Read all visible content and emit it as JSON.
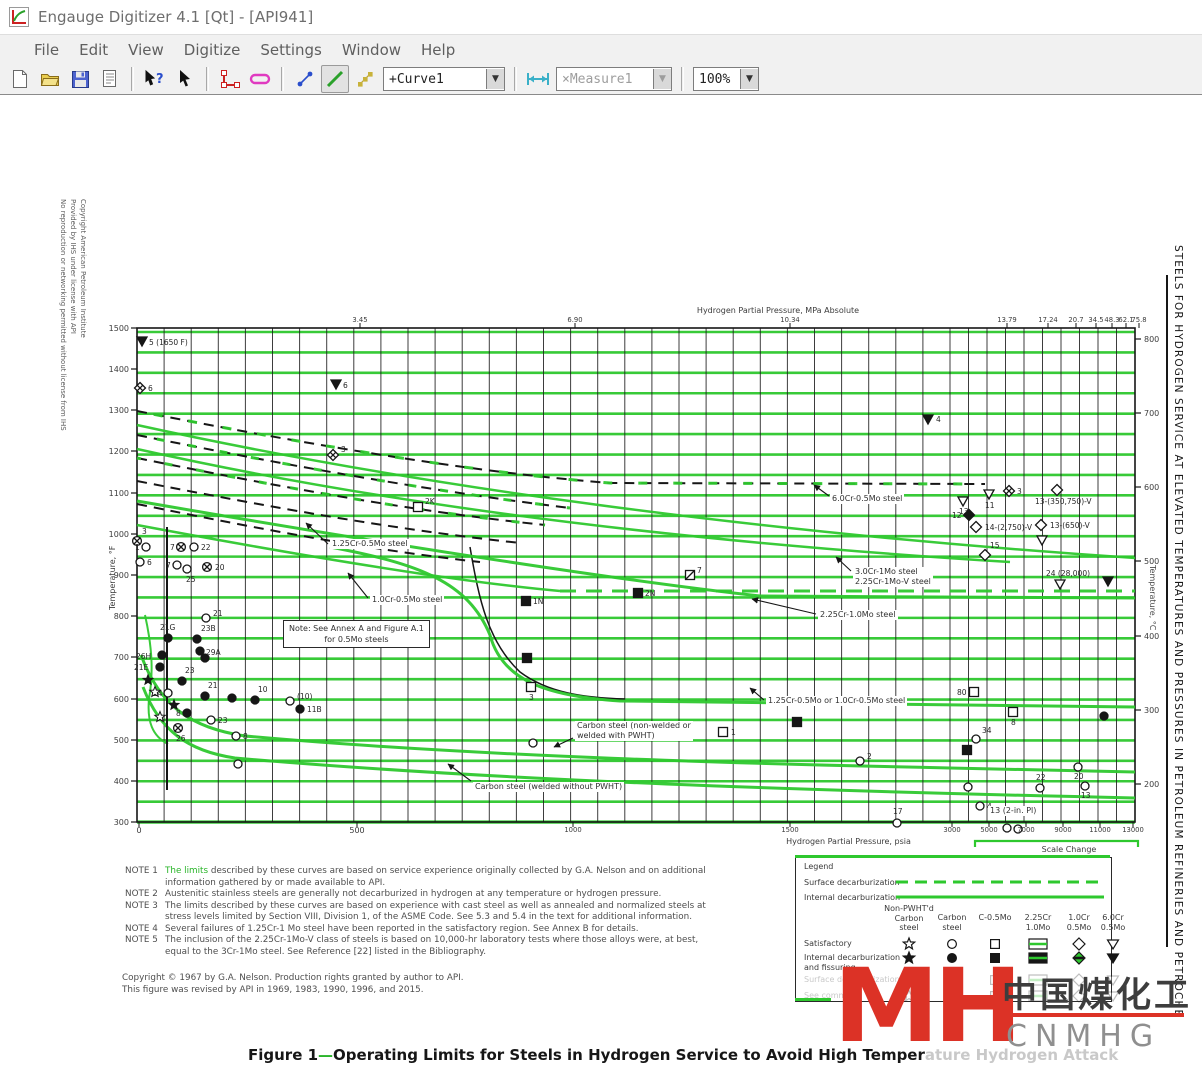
{
  "window": {
    "title": "Engauge Digitizer 4.1 [Qt] - [API941]",
    "menus": [
      "File",
      "Edit",
      "View",
      "Digitize",
      "Settings",
      "Window",
      "Help"
    ]
  },
  "toolbar": {
    "curve_select": "+Curve1",
    "measure_select": "×Measure1",
    "zoom_select": "100%"
  },
  "side_texts": {
    "left_copyright": [
      "Copyright American Petroleum Institute",
      "Provided by IHS under license with API",
      "No reproduction or networking permitted without license from IHS"
    ],
    "right_title": "STEELS FOR HYDROGEN SERVICE AT ELEVATED TEMPERATURES AND PRESSURES IN PETROLEUM REFINERIES AND PETROCHE"
  },
  "chart": {
    "plot": {
      "x0": 137,
      "y0": 233,
      "x1": 1135,
      "y1": 727
    },
    "grid": {
      "vx_main": {
        "start": 137,
        "end": 950,
        "step": 27.1
      },
      "vx_right": {
        "start": 950,
        "end": 1135,
        "step": 18.5
      },
      "hy": {
        "start": 237,
        "end": 727,
        "step": 20.42
      }
    },
    "top_axis": {
      "title": "Hydrogen Partial Pressure, MPa Absolute",
      "ticks": [
        {
          "t": "3.45",
          "x": 360
        },
        {
          "t": "6.90",
          "x": 575
        },
        {
          "t": "10.34",
          "x": 790
        },
        {
          "t": "13.79",
          "x": 1007
        },
        {
          "t": "17.24",
          "x": 1048
        },
        {
          "t": "20.7",
          "x": 1076
        },
        {
          "t": "34.5",
          "x": 1096
        },
        {
          "t": "48.3",
          "x": 1112
        },
        {
          "t": "62.1",
          "x": 1126
        },
        {
          "t": "75.8",
          "x": 1139
        }
      ]
    },
    "bottom_axis": {
      "title": "Hydrogen Partial Pressure, psia",
      "ticks": [
        {
          "t": "0",
          "x": 139
        },
        {
          "t": "500",
          "x": 357
        },
        {
          "t": "1000",
          "x": 573
        },
        {
          "t": "1500",
          "x": 790
        },
        {
          "t": "3000",
          "x": 952
        },
        {
          "t": "5000",
          "x": 989
        },
        {
          "t": "7000",
          "x": 1026
        },
        {
          "t": "9000",
          "x": 1063
        },
        {
          "t": "11000",
          "x": 1100
        },
        {
          "t": "13000",
          "x": 1133
        }
      ]
    },
    "left_axis": {
      "title": "Temperature, °F",
      "ticks": [
        {
          "t": "1500",
          "y": 233
        },
        {
          "t": "1400",
          "y": 274
        },
        {
          "t": "1300",
          "y": 315
        },
        {
          "t": "1200",
          "y": 356
        },
        {
          "t": "1100",
          "y": 398
        },
        {
          "t": "1000",
          "y": 439
        },
        {
          "t": "900",
          "y": 480
        },
        {
          "t": "800",
          "y": 521
        },
        {
          "t": "700",
          "y": 562
        },
        {
          "t": "600",
          "y": 604
        },
        {
          "t": "500",
          "y": 645
        },
        {
          "t": "400",
          "y": 686
        },
        {
          "t": "300",
          "y": 727
        }
      ]
    },
    "right_axis": {
      "title": "Temperature, °C",
      "ticks": [
        {
          "t": "800",
          "y": 244
        },
        {
          "t": "700",
          "y": 318
        },
        {
          "t": "600",
          "y": 392
        },
        {
          "t": "500",
          "y": 466
        },
        {
          "t": "400",
          "y": 541
        },
        {
          "t": "300",
          "y": 615
        },
        {
          "t": "200",
          "y": 689
        }
      ]
    },
    "scale_change": {
      "label": "Scale Change",
      "x1": 975,
      "x2": 1138,
      "y": 746
    },
    "note_box": {
      "lines": [
        "Note:  See Annex A and Figure A.1",
        "for 0.5Mo steels"
      ],
      "x": 283,
      "y": 525
    },
    "labels": [
      {
        "lines": [
          "1.25Cr-0.5Mo steel"
        ],
        "x": 330,
        "y": 444,
        "arrow": [
          328,
          449,
          306,
          428
        ]
      },
      {
        "lines": [
          "1.0Cr-0.5Mo steel"
        ],
        "x": 370,
        "y": 500,
        "arrow": [
          368,
          503,
          348,
          478
        ]
      },
      {
        "lines": [
          "6.0Cr-0.5Mo steel"
        ],
        "x": 830,
        "y": 399,
        "arrow": [
          829,
          401,
          814,
          390
        ]
      },
      {
        "lines": [
          "3.0Cr-1Mo steel",
          "2.25Cr-1Mo-V steel"
        ],
        "x": 853,
        "y": 472,
        "arrow": [
          851,
          476,
          836,
          462
        ]
      },
      {
        "lines": [
          "2.25Cr-1.0Mo steel"
        ],
        "x": 818,
        "y": 515,
        "arrow": [
          816,
          519,
          752,
          504
        ]
      },
      {
        "lines": [
          "1.25Cr-0.5Mo or 1.0Cr-0.5Mo steel"
        ],
        "x": 766,
        "y": 601,
        "arrow": [
          764,
          605,
          750,
          593
        ]
      },
      {
        "lines": [
          "Carbon steel (non-welded or",
          "welded with PWHT)"
        ],
        "x": 575,
        "y": 626,
        "arrow": [
          573,
          643,
          554,
          652
        ]
      },
      {
        "lines": [
          "Carbon steel (welded without PWHT)"
        ],
        "x": 473,
        "y": 687,
        "arrow": [
          471,
          686,
          448,
          669
        ]
      },
      {
        "lines": [
          "13 (2-in. Pl)"
        ],
        "x": 988,
        "y": 711,
        "arrow": null
      }
    ],
    "green_curves": [
      {
        "d": "M137,330 C420,392 760,438 1135,463",
        "w": 2.5
      },
      {
        "d": "M137,354 C400,413 700,448 1010,467",
        "w": 2.5
      },
      {
        "d": "M137,406 C420,455 640,488 760,501 L1135,503",
        "w": 3
      },
      {
        "d": "M137,430 C340,468 480,489 560,496",
        "w": 2.5
      },
      {
        "d": "M560,496 L1135,496",
        "w": 3,
        "dash": "16,10"
      },
      {
        "d": "M330,452 C420,469 468,487 490,540 C502,585 545,601 620,606 L1135,612",
        "w": 3
      },
      {
        "d": "M141,560 C160,612 192,633 245,641 C480,662 760,669 950,673 L1135,677",
        "w": 3
      },
      {
        "d": "M143,592 C160,636 188,656 235,663 C500,686 820,696 1135,703",
        "w": 3
      },
      {
        "d": "M145,520 C153,556 153,580 149,604 C147,626 152,641 168,649",
        "w": 2
      },
      {
        "d": "M137,316 C320,352 480,378 610,388 L985,389",
        "w": 3,
        "dash": "9,26",
        "off": 18
      },
      {
        "d": "M137,340 C290,371 430,396 570,413",
        "w": 3,
        "dash": "8,24",
        "off": 12
      },
      {
        "d": "M137,363 C280,392 410,416 545,430",
        "w": 3,
        "dash": "8,24",
        "off": 4
      }
    ],
    "black_curves": [
      {
        "d": "M137,316 C320,352 480,378 610,388 L985,389",
        "w": 2,
        "dash": "10,7"
      },
      {
        "d": "M137,340 C290,371 430,396 570,413",
        "w": 2,
        "dash": "10,7"
      },
      {
        "d": "M137,363 C280,392 410,416 545,430",
        "w": 2,
        "dash": "10,7"
      },
      {
        "d": "M137,386 C270,412 390,434 520,448",
        "w": 2,
        "dash": "10,7"
      },
      {
        "d": "M137,409 C260,434 370,455 480,467",
        "w": 2,
        "dash": "10,7"
      },
      {
        "d": "M470,452 C479,505 488,547 520,577 C548,598 585,603 625,604",
        "w": 1.5
      }
    ],
    "extra_lines": [
      {
        "x1": 167,
        "y1": 432,
        "x2": 167,
        "y2": 695,
        "w": 2
      }
    ],
    "points": [
      {
        "s": "tf",
        "x": 142,
        "y": 246,
        "t": "5 (1650 F)",
        "dx": 7,
        "dy": 4
      },
      {
        "s": "dx",
        "x": 140,
        "y": 293,
        "t": "6",
        "dx": 8,
        "dy": 3
      },
      {
        "s": "tf",
        "x": 336,
        "y": 289,
        "t": "6",
        "dx": 7,
        "dy": 4
      },
      {
        "s": "dx",
        "x": 333,
        "y": 360,
        "t": "3",
        "dx": 8,
        "dy": -3
      },
      {
        "s": "tf",
        "x": 928,
        "y": 324,
        "t": "4",
        "dx": 8,
        "dy": 3
      },
      {
        "s": "so",
        "x": 418,
        "y": 412,
        "t": "2K",
        "dx": 7,
        "dy": -3
      },
      {
        "s": "to",
        "x": 963,
        "y": 406,
        "t": "13",
        "dx": -4,
        "dy": 13
      },
      {
        "s": "to",
        "x": 989,
        "y": 399,
        "t": "11",
        "dx": -4,
        "dy": 14
      },
      {
        "s": "dx",
        "x": 1009,
        "y": 396,
        "t": "3",
        "dx": 8,
        "dy": 3
      },
      {
        "s": "do",
        "x": 1057,
        "y": 395,
        "t": "13-(350,750)-V",
        "dx": -22,
        "dy": 14
      },
      {
        "s": "df",
        "x": 969,
        "y": 420,
        "t": "12",
        "dx": -17,
        "dy": 3
      },
      {
        "s": "do",
        "x": 976,
        "y": 432,
        "t": "14-(2,750)-V",
        "dx": 9,
        "dy": 3
      },
      {
        "s": "do",
        "x": 1041,
        "y": 430,
        "t": "13-(650)-V",
        "dx": 9,
        "dy": 3
      },
      {
        "s": "to",
        "x": 1042,
        "y": 445,
        "t": ""
      },
      {
        "s": "do",
        "x": 985,
        "y": 460,
        "t": "15",
        "dx": 5,
        "dy": -7
      },
      {
        "s": "to",
        "x": 1060,
        "y": 489,
        "t": "24 (28,000)",
        "dx": -14,
        "dy": -8
      },
      {
        "s": "tf",
        "x": 1108,
        "y": 486,
        "t": ""
      },
      {
        "s": "sf",
        "x": 638,
        "y": 498,
        "t": "2N",
        "dx": 7,
        "dy": 3
      },
      {
        "s": "sf",
        "x": 526,
        "y": 506,
        "t": "1N",
        "dx": 7,
        "dy": 3
      },
      {
        "s": "sx",
        "x": 690,
        "y": 480,
        "t": "7",
        "dx": 7,
        "dy": -2
      },
      {
        "s": "sf",
        "x": 527,
        "y": 563,
        "t": ""
      },
      {
        "s": "so",
        "x": 531,
        "y": 592,
        "t": "3",
        "dx": -2,
        "dy": 13
      },
      {
        "s": "so",
        "x": 723,
        "y": 637,
        "t": "1",
        "dx": 8,
        "dy": 3
      },
      {
        "s": "co",
        "x": 860,
        "y": 666,
        "t": "2",
        "dx": 7,
        "dy": -2
      },
      {
        "s": "co",
        "x": 897,
        "y": 728,
        "t": "17",
        "dx": -4,
        "dy": -9
      },
      {
        "s": "so",
        "x": 974,
        "y": 597,
        "t": "80",
        "dx": -17,
        "dy": 3
      },
      {
        "s": "so",
        "x": 1013,
        "y": 617,
        "t": "8",
        "dx": -2,
        "dy": 13
      },
      {
        "s": "cf",
        "x": 1104,
        "y": 621,
        "t": ""
      },
      {
        "s": "sf",
        "x": 967,
        "y": 655,
        "t": ""
      },
      {
        "s": "co",
        "x": 976,
        "y": 644,
        "t": "34",
        "dx": 6,
        "dy": -6
      },
      {
        "s": "co",
        "x": 1078,
        "y": 672,
        "t": "20",
        "dx": -4,
        "dy": 12
      },
      {
        "s": "co",
        "x": 1085,
        "y": 691,
        "t": "13",
        "dx": -4,
        "dy": 12
      },
      {
        "s": "co",
        "x": 968,
        "y": 692,
        "t": ""
      },
      {
        "s": "co",
        "x": 980,
        "y": 711,
        "t": "4",
        "dx": 7,
        "dy": 3
      },
      {
        "s": "co",
        "x": 1007,
        "y": 733,
        "t": ""
      },
      {
        "s": "co",
        "x": 1018,
        "y": 734,
        "t": ""
      },
      {
        "s": "co",
        "x": 1040,
        "y": 693,
        "t": "22",
        "dx": -4,
        "dy": -8
      },
      {
        "s": "sf",
        "x": 797,
        "y": 627,
        "t": ""
      },
      {
        "s": "co",
        "x": 533,
        "y": 648,
        "t": ""
      },
      {
        "s": "cx",
        "x": 137,
        "y": 446,
        "t": "3",
        "dx": 5,
        "dy": -7
      },
      {
        "s": "co",
        "x": 146,
        "y": 452,
        "t": "1",
        "dx": -11,
        "dy": 3
      },
      {
        "s": "co",
        "x": 140,
        "y": 467,
        "t": "6",
        "dx": 7,
        "dy": 3
      },
      {
        "s": "cx",
        "x": 181,
        "y": 452,
        "t": "7",
        "dx": -11,
        "dy": 3
      },
      {
        "s": "co",
        "x": 194,
        "y": 452,
        "t": "22",
        "dx": 7,
        "dy": 3
      },
      {
        "s": "co",
        "x": 177,
        "y": 470,
        "t": "7",
        "dx": -11,
        "dy": 3
      },
      {
        "s": "co",
        "x": 187,
        "y": 474,
        "t": "25",
        "dx": -1,
        "dy": 13
      },
      {
        "s": "cx",
        "x": 207,
        "y": 472,
        "t": "20",
        "dx": 8,
        "dy": 3
      },
      {
        "s": "co",
        "x": 206,
        "y": 523,
        "t": "21",
        "dx": 7,
        "dy": -2
      },
      {
        "s": "cf",
        "x": 168,
        "y": 543,
        "t": "21G",
        "dx": -8,
        "dy": -8
      },
      {
        "s": "cf",
        "x": 197,
        "y": 544,
        "t": "23B",
        "dx": 4,
        "dy": -8
      },
      {
        "s": "cf",
        "x": 162,
        "y": 560,
        "t": "26H",
        "dx": -26,
        "dy": 4
      },
      {
        "s": "cf",
        "x": 200,
        "y": 556,
        "t": "29A",
        "dx": 6,
        "dy": 4
      },
      {
        "s": "cf",
        "x": 160,
        "y": 572,
        "t": "21E",
        "dx": -26,
        "dy": 3
      },
      {
        "s": "cf",
        "x": 205,
        "y": 563,
        "t": ""
      },
      {
        "s": "st",
        "x": 148,
        "y": 585,
        "t": ""
      },
      {
        "s": "cf",
        "x": 182,
        "y": 586,
        "t": "23",
        "dx": 3,
        "dy": -8
      },
      {
        "s": "co",
        "x": 168,
        "y": 598,
        "t": "24",
        "dx": -15,
        "dy": 3
      },
      {
        "s": "cf",
        "x": 205,
        "y": 601,
        "t": "21",
        "dx": 3,
        "dy": -8
      },
      {
        "s": "cf",
        "x": 232,
        "y": 603,
        "t": ""
      },
      {
        "s": "cf",
        "x": 255,
        "y": 605,
        "t": "10",
        "dx": 3,
        "dy": -8
      },
      {
        "s": "co",
        "x": 290,
        "y": 606,
        "t": "(10)",
        "dx": 7,
        "dy": -2
      },
      {
        "s": "cf",
        "x": 300,
        "y": 614,
        "t": "11B",
        "dx": 7,
        "dy": 3
      },
      {
        "s": "cf",
        "x": 187,
        "y": 618,
        "t": "8",
        "dx": -11,
        "dy": 3
      },
      {
        "s": "st",
        "x": 174,
        "y": 610,
        "t": ""
      },
      {
        "s": "sO",
        "x": 160,
        "y": 622,
        "t": ""
      },
      {
        "s": "cx",
        "x": 178,
        "y": 633,
        "t": "26",
        "dx": -2,
        "dy": 13
      },
      {
        "s": "co",
        "x": 211,
        "y": 625,
        "t": "23",
        "dx": 7,
        "dy": 3
      },
      {
        "s": "co",
        "x": 236,
        "y": 641,
        "t": "8",
        "dx": 7,
        "dy": 3
      },
      {
        "s": "co",
        "x": 238,
        "y": 669,
        "t": ""
      },
      {
        "s": "sO",
        "x": 155,
        "y": 597,
        "t": ""
      }
    ]
  },
  "notes": [
    {
      "label": "NOTE 1",
      "text": "The limits described by these curves are based on service experience originally collected by G.A. Nelson and on additional information gathered by or made available to API."
    },
    {
      "label": "NOTE 2",
      "text": "Austenitic stainless steels are generally not decarburized in hydrogen at any temperature or hydrogen pressure."
    },
    {
      "label": "NOTE 3",
      "text": "The limits described by these curves are based on experience with cast steel as well as annealed and normalized steels at stress levels limited by Section VIII, Division 1, of the ASME Code. See 5.3 and 5.4 in the text for additional information."
    },
    {
      "label": "NOTE 4",
      "text": "Several failures of 1.25Cr-1 Mo steel have been reported in the satisfactory region. See Annex B for details."
    },
    {
      "label": "NOTE 5",
      "text": "The inclusion of the 2.25Cr-1Mo-V class of steels is based on 10,000-hr laboratory tests where those alloys were, at best, equal to the 3Cr-1Mo steel.  See Reference [22] listed in the Bibliography."
    }
  ],
  "copyright_lines": [
    "Copyright © 1967 by G.A. Nelson. Production rights granted by author to API.",
    "This figure was revised by API in 1969, 1983, 1990, 1996, and 2015."
  ],
  "legend": {
    "title": "Legend",
    "line_rows": [
      {
        "label": "Surface decarburization",
        "style": "dashed"
      },
      {
        "label": "Internal decarburization",
        "style": "solid"
      }
    ],
    "col_headers": [
      [
        "Non-PWHT'd",
        "Carbon",
        "steel"
      ],
      [
        "Carbon",
        "steel"
      ],
      [
        "C-0.5Mo"
      ],
      [
        "2.25Cr",
        "1.0Mo"
      ],
      [
        "1.0Cr",
        "0.5Mo"
      ],
      [
        "6.0Cr",
        "0.5Mo"
      ]
    ],
    "rows": [
      {
        "label": [
          "Satisfactory"
        ],
        "symbols": [
          "star-o",
          "circ-o",
          "sq-o",
          "rect-o",
          "dia-o",
          "tri-o"
        ],
        "faded": false
      },
      {
        "label": [
          "Internal decarburization",
          "and fissuring"
        ],
        "symbols": [
          "star-f",
          "circ-f",
          "sq-f",
          "rect-f",
          "dia-g",
          "tri-f"
        ],
        "faded": false
      },
      {
        "label": [
          "Surface decarburization"
        ],
        "symbols": [
          "star-o",
          "circ-o",
          "sq-o",
          "rect-o",
          "dia-o",
          "tri-o"
        ],
        "faded": true
      },
      {
        "label": [
          "See comment"
        ],
        "symbols": [
          "star-o",
          "circ-o",
          "sq-o",
          "rect-o",
          "dia-o",
          "tri-o"
        ],
        "faded": true
      }
    ]
  },
  "caption": {
    "part1": "Figure  1",
    "dash": "—",
    "part2": "Operating Limits for Steels in Hydrogen Service to Avoid High Temper",
    "faded": "ature Hydrogen Attack"
  },
  "watermark": {
    "logo": "MH",
    "cjk": "中国煤化工",
    "latin": "CNMHG"
  },
  "colors": {
    "green": "#2ec82e",
    "red": "#dc3226",
    "black": "#161616"
  }
}
